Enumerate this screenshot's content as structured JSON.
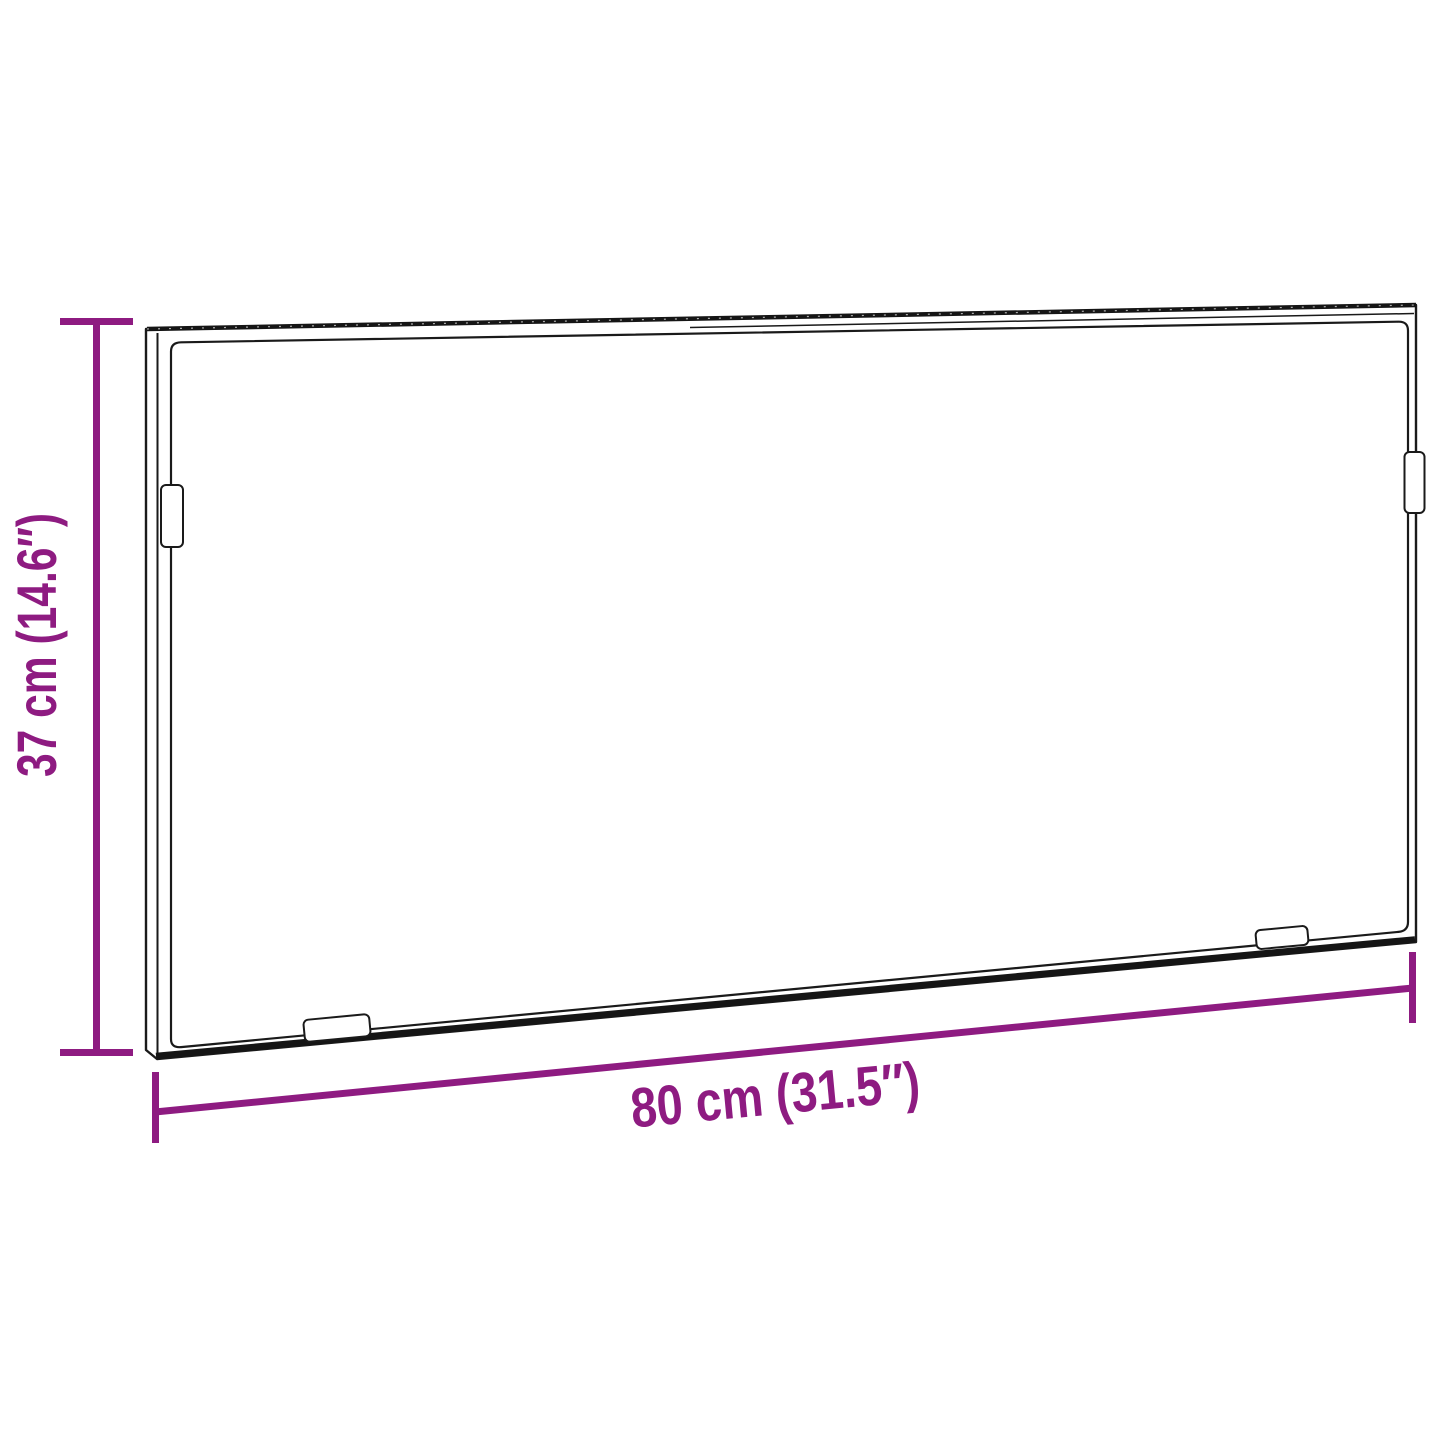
{
  "diagram": {
    "subject": "rectangular wall panel with four mounting brackets, drawn in slight perspective",
    "background": "#ffffff"
  },
  "dimensions": {
    "height": {
      "label": "37 cm (14.6″)",
      "cm": 37,
      "inches": 14.6,
      "orientation": "vertical-left"
    },
    "width": {
      "label": "80 cm (31.5″)",
      "cm": 80,
      "inches": 31.5,
      "orientation": "horizontal-bottom"
    }
  },
  "colors": {
    "dimension_accent": "#8e1b81",
    "outline": "#1a1a1a",
    "background": "#ffffff"
  }
}
